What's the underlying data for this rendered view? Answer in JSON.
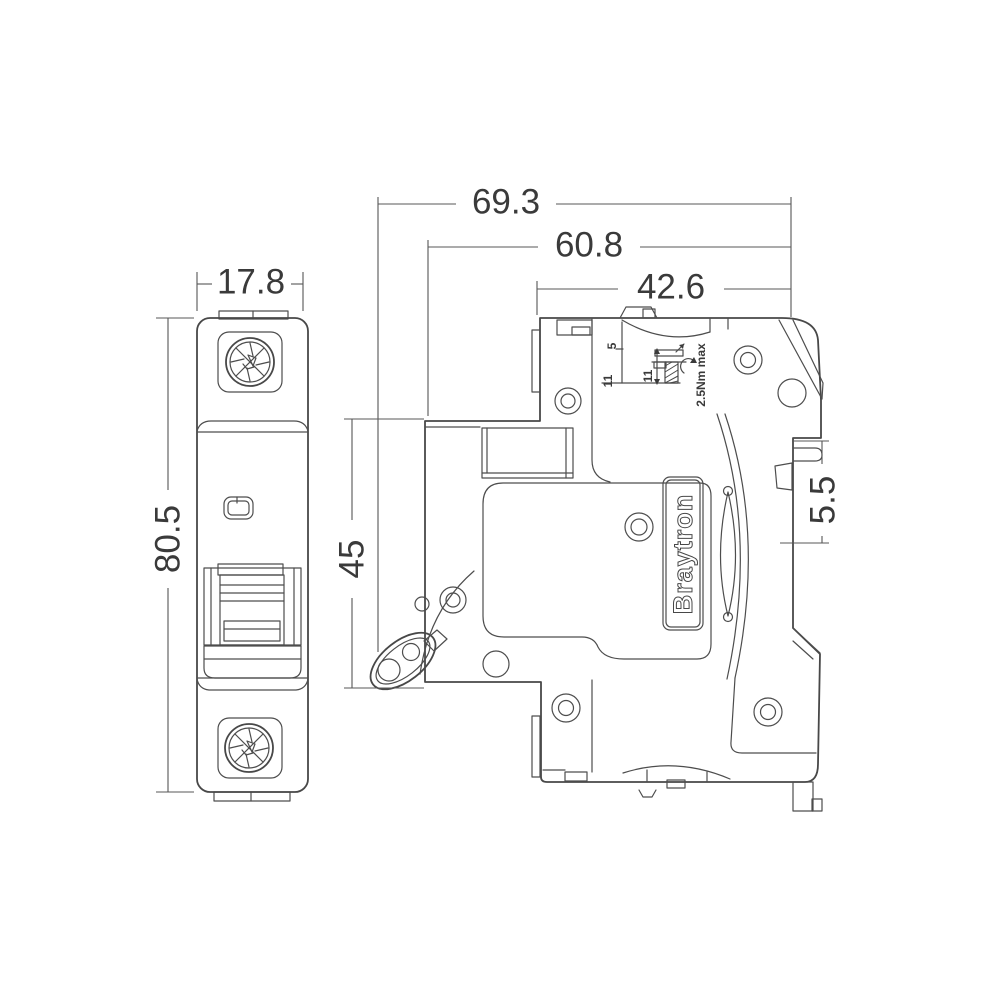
{
  "drawing": {
    "kind": "technical dimension drawing, two orthographic views of a DIN-rail circuit breaker"
  },
  "dimensions": {
    "front_width": "17.8",
    "front_height": "80.5",
    "side_total_depth": "69.3",
    "side_body_depth": "60.8",
    "side_top_depth": "42.6",
    "side_front_height": "45",
    "din_recess_depth": "5.5"
  },
  "terminal_detail": {
    "strip_depth_upper": "5",
    "strip_depth_lower": "11",
    "screw_length": "11",
    "torque": "2.5Nm max"
  },
  "brand": {
    "label": "Braytron"
  },
  "colors": {
    "line": "#484848",
    "dimension_line": "#575757",
    "text": "#3a3a3a",
    "background": "#ffffff"
  }
}
